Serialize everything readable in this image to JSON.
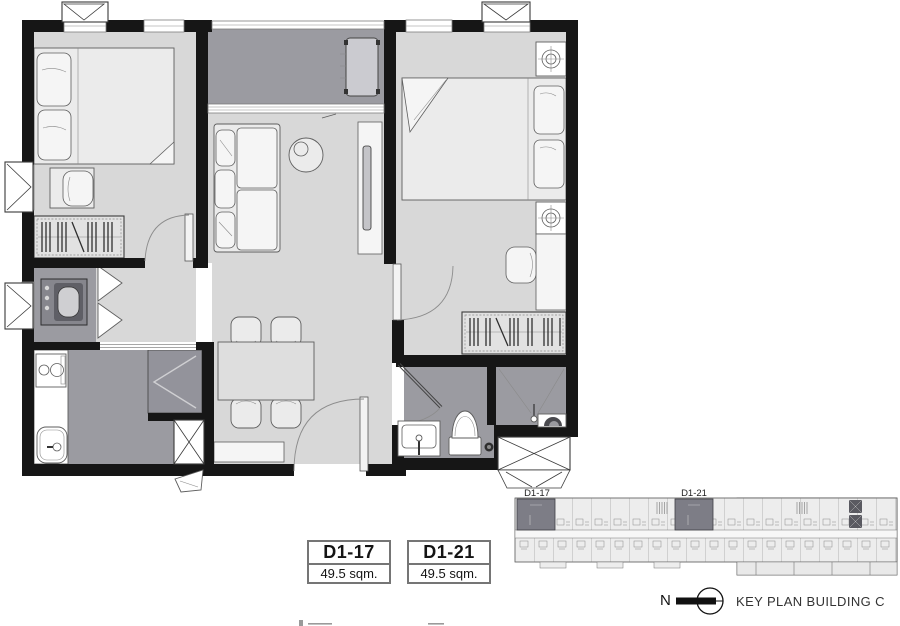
{
  "unit_labels": [
    {
      "code": "D1-17",
      "area": "49.5 sqm."
    },
    {
      "code": "D1-21",
      "area": "49.5 sqm."
    }
  ],
  "key_plan": {
    "tag_left": "D1-17",
    "tag_right": "D1-21",
    "north_label": "N",
    "title": "KEY PLAN BUILDING C"
  },
  "colors": {
    "wall": "#161616",
    "floor_light": "#d8d8d8",
    "floor_wet": "#9b9ba1",
    "highlight_unit": "#7d7d86",
    "keyplan_fill": "#ededed"
  }
}
